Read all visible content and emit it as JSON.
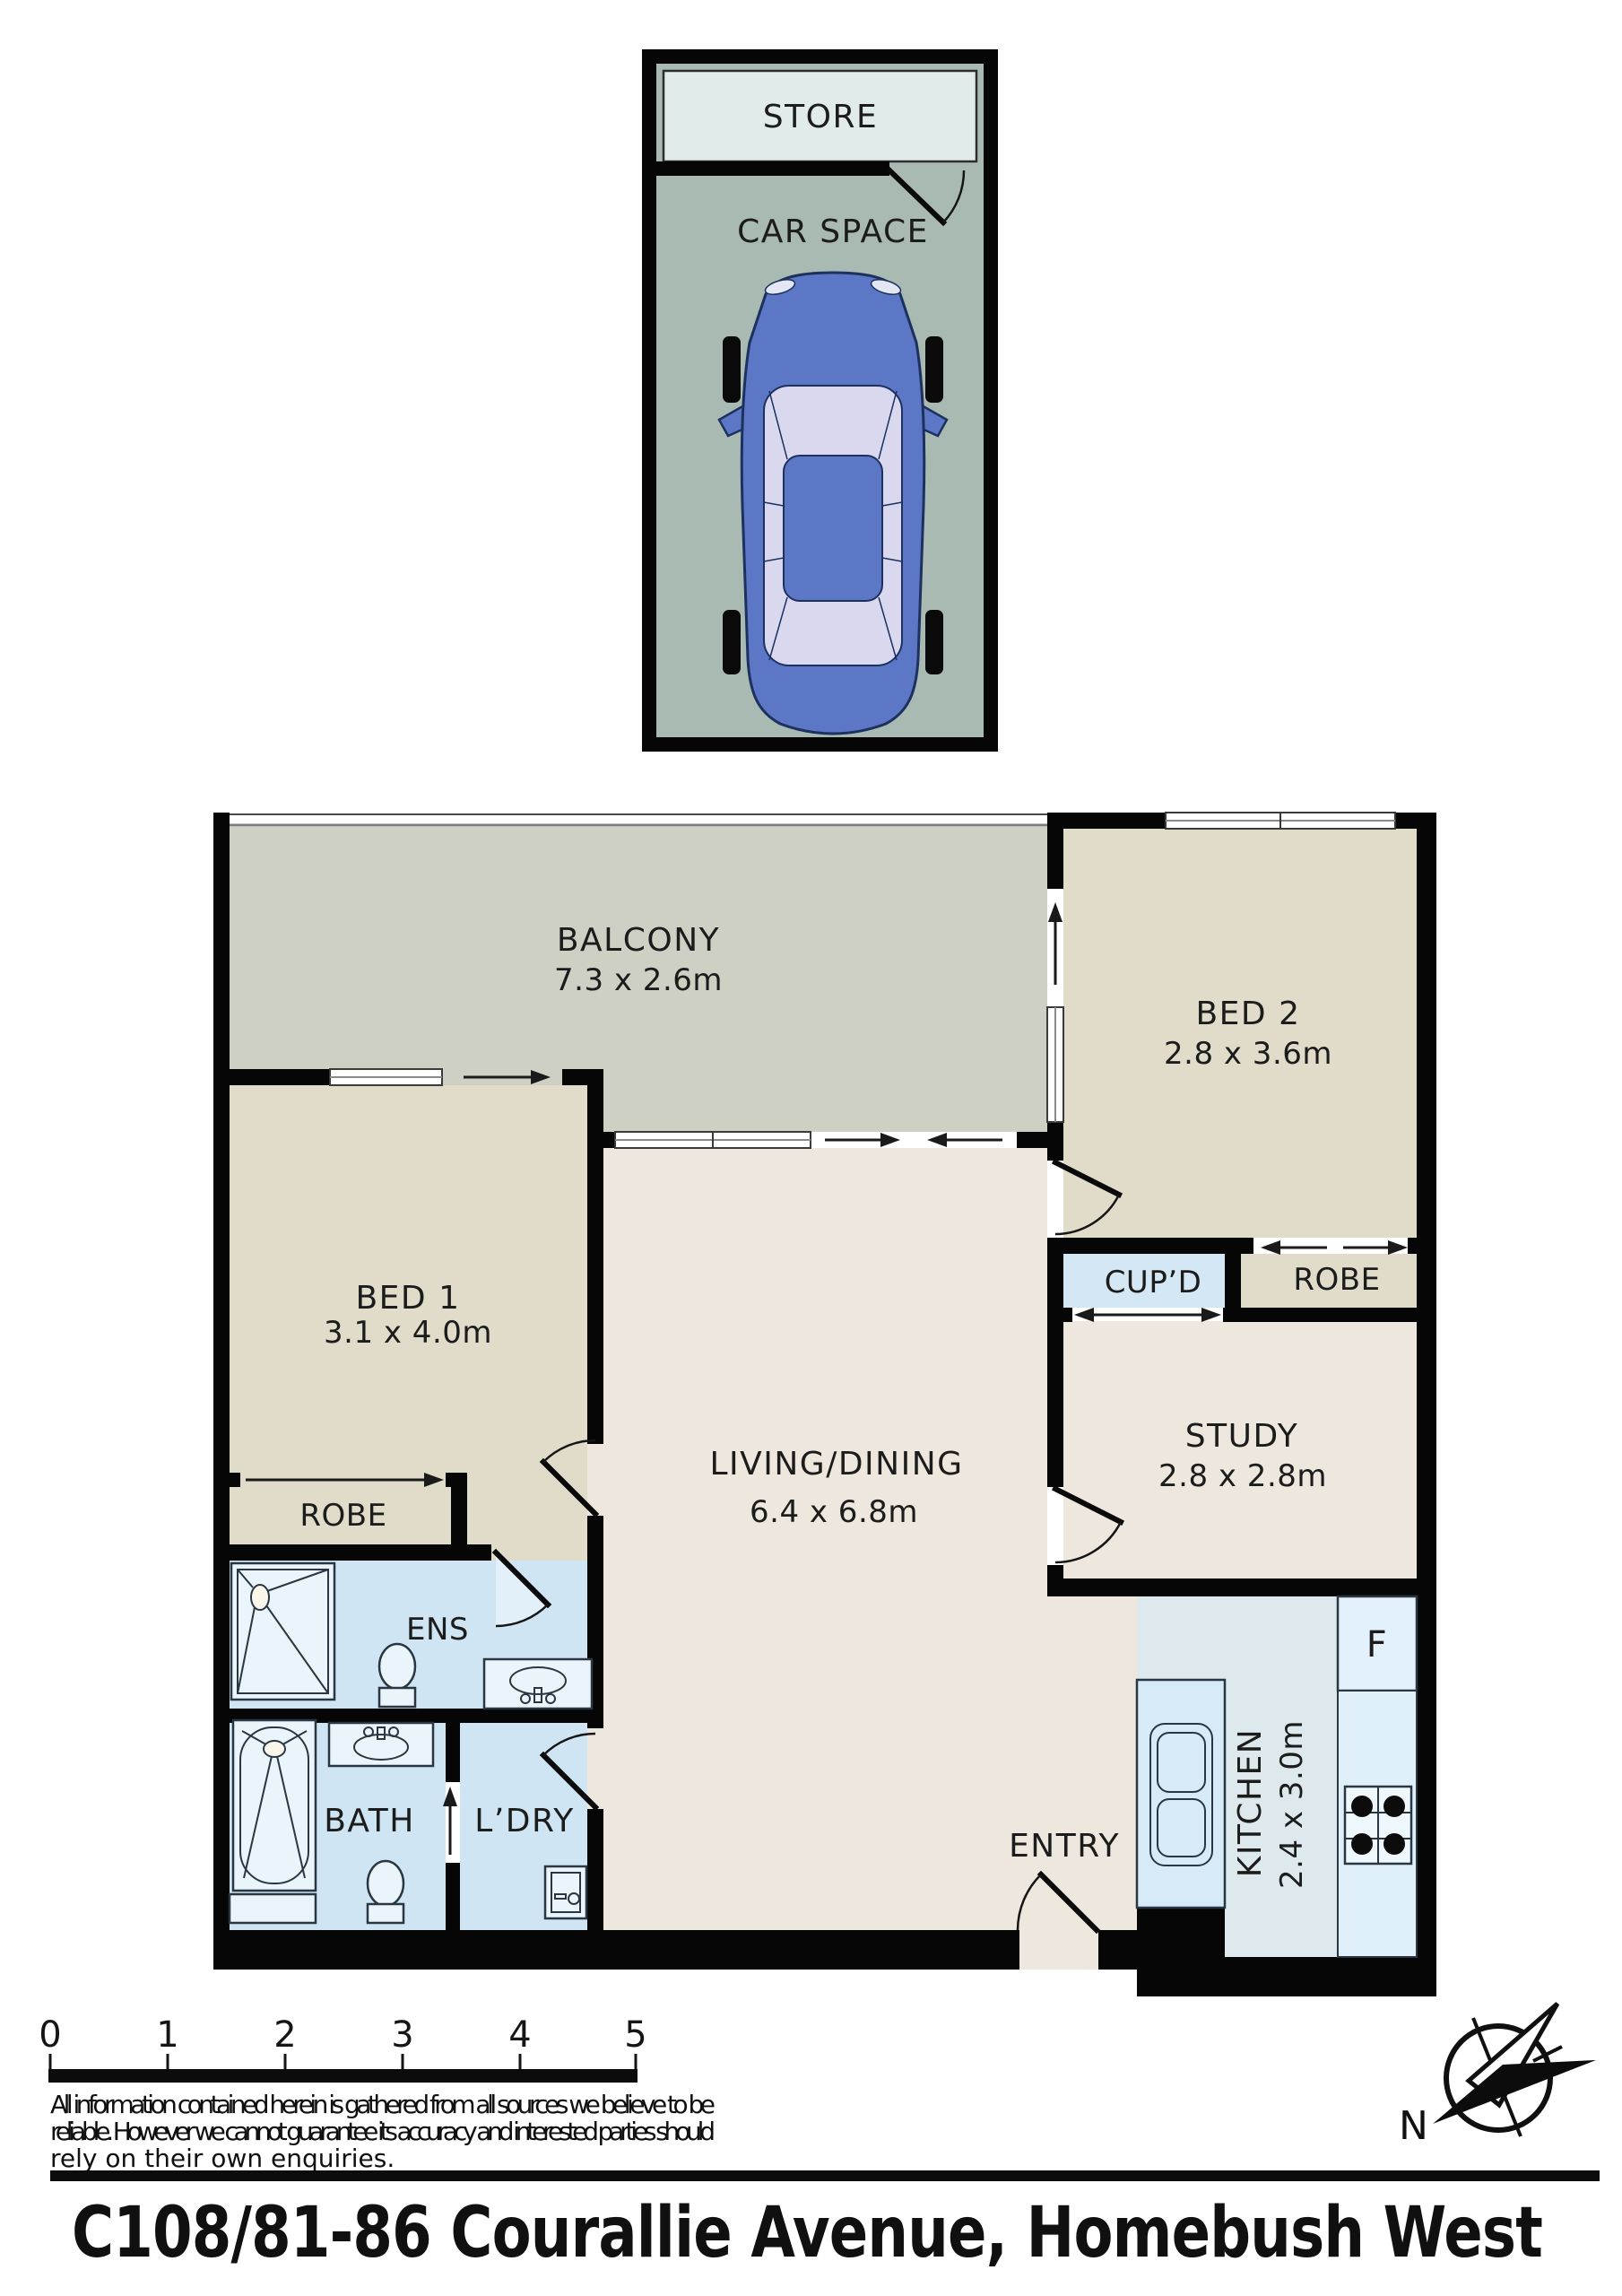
{
  "garage": {
    "store_label": "STORE",
    "car_space_label": "CAR SPACE"
  },
  "rooms": {
    "balcony": {
      "name": "BALCONY",
      "dims": "7.3 x 2.6m"
    },
    "bed2": {
      "name": "BED 2",
      "dims": "2.8 x 3.6m"
    },
    "bed1": {
      "name": "BED 1",
      "dims": "3.1 x 4.0m"
    },
    "living": {
      "name": "LIVING/DINING",
      "dims": "6.4 x 6.8m"
    },
    "study": {
      "name": "STUDY",
      "dims": "2.8 x 2.8m"
    },
    "kitchen": {
      "name": "KITCHEN",
      "dims": "2.4 x 3.0m"
    },
    "ens": {
      "name": "ENS"
    },
    "bath": {
      "name": "BATH"
    },
    "ldry": {
      "name": "L’DRY"
    },
    "entry": {
      "name": "ENTRY"
    },
    "robe_bed1": {
      "name": "ROBE"
    },
    "robe_bed2": {
      "name": "ROBE"
    },
    "cupd": {
      "name": "CUP’D"
    },
    "fridge": {
      "name": "F"
    }
  },
  "scale_bar": {
    "ticks": [
      "0",
      "1",
      "2",
      "3",
      "4",
      "5"
    ]
  },
  "compass": {
    "north_label": "N"
  },
  "disclaimer": {
    "line1": "All information contained herein is gathered from all sources we believe to be",
    "line2": "reliable. However we cannot guarantee its accuracy and interested parties should",
    "line3": "rely on their own enquiries."
  },
  "footer": {
    "address": "C108/81-86 Courallie Avenue, Homebush West"
  },
  "colors": {
    "wall": "#060606",
    "bedroom_fill": "#e0dcc9",
    "balcony_fill": "#cdd0c3",
    "living_fill": "#ede7dd",
    "wet_fill": "#cfe5f3",
    "kitchen_fill": "#dde9ec",
    "car_space_fill": "#a9bab3",
    "store_fill": "#e1ebea",
    "car_body": "#5b77c5",
    "car_glass": "#d9d8ef"
  }
}
